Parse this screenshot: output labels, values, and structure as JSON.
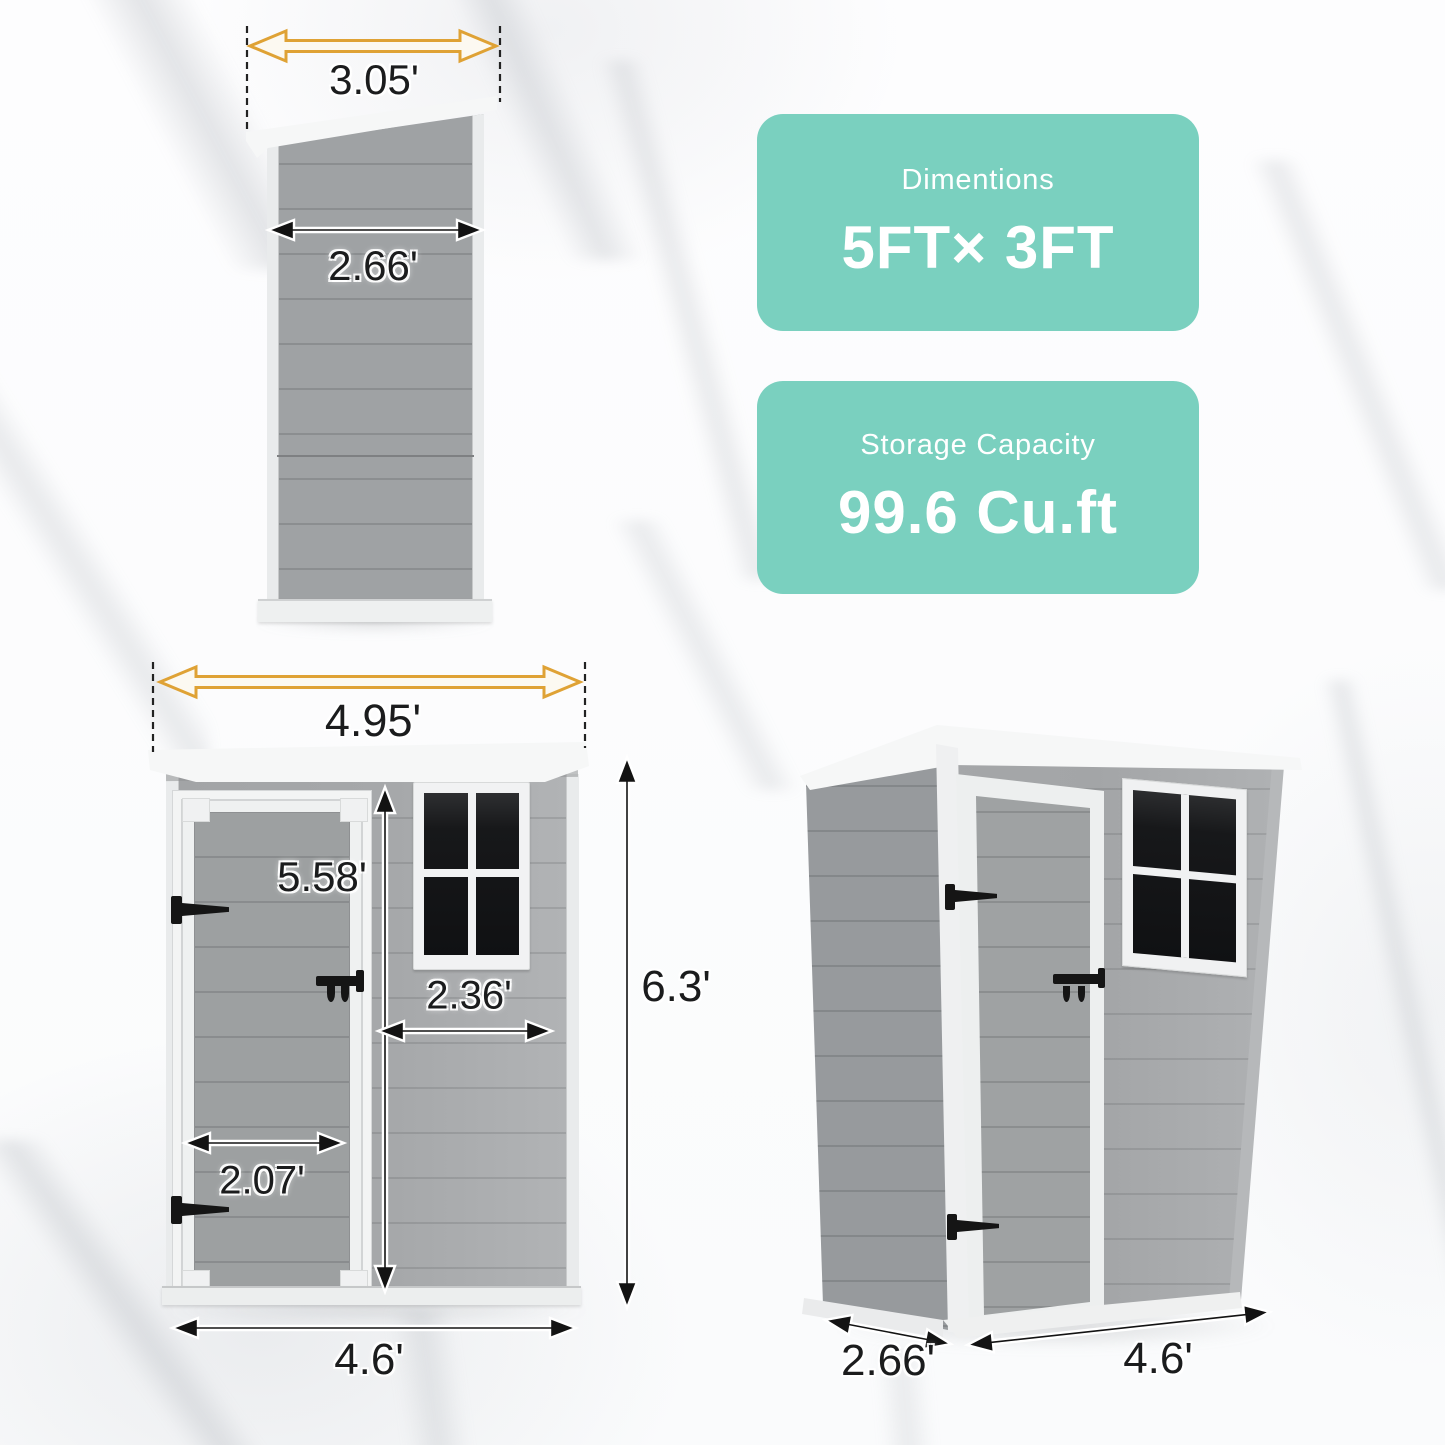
{
  "cards": [
    {
      "title": "Dimentions",
      "value": "5FT× 3FT"
    },
    {
      "title": "Storage Capacity",
      "value": "99.6 Cu.ft"
    }
  ],
  "dimensions": {
    "side_view": {
      "roof_width": "3.05'",
      "body_depth": "2.66'"
    },
    "front_view": {
      "roof_width": "4.95'",
      "door_height": "5.58'",
      "window_width": "2.36'",
      "door_width": "2.07'",
      "overall_height": "6.3'",
      "overall_width": "4.6'"
    },
    "perspective_view": {
      "depth": "2.66'",
      "width": "4.6'"
    }
  },
  "colors": {
    "teal": "#7ad0bf",
    "arrow_yellow": "#dfa235",
    "wall_gray": "#a4a7a9",
    "window_pane": "#17181a"
  }
}
